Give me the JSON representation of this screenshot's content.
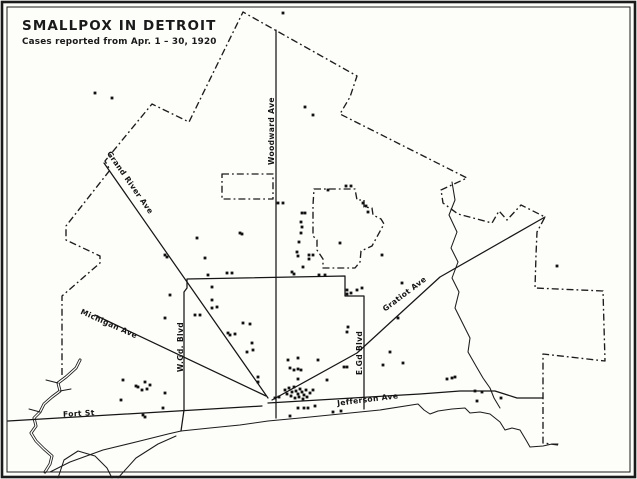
{
  "title": "SMALLPOX IN DETROIT",
  "subtitle": "Cases reported from Apr. 1 – 30, 1920",
  "colors": {
    "ink": "#1a1a1a",
    "paper": "#fdfdfa"
  },
  "map": {
    "width": 637,
    "height": 479,
    "city_boundary": [
      [
        [
          62,
          375
        ],
        [
          62,
          296
        ],
        [
          100,
          263
        ],
        [
          100,
          256
        ],
        [
          66,
          240
        ],
        [
          66,
          226
        ],
        [
          110,
          170
        ],
        [
          105,
          161
        ],
        [
          152,
          104
        ],
        [
          189,
          122
        ],
        [
          243,
          12
        ],
        [
          357,
          76
        ],
        [
          350,
          97
        ],
        [
          340,
          114
        ],
        [
          467,
          178
        ],
        [
          441,
          190
        ],
        [
          443,
          203
        ],
        [
          458,
          214
        ],
        [
          492,
          223
        ],
        [
          499,
          211
        ],
        [
          507,
          220
        ],
        [
          521,
          205
        ],
        [
          545,
          217
        ],
        [
          537,
          232
        ],
        [
          536,
          255
        ],
        [
          535,
          288
        ],
        [
          603,
          291
        ],
        [
          605,
          361
        ],
        [
          543,
          354
        ],
        [
          543,
          443
        ],
        [
          558,
          445
        ]
      ]
    ],
    "enclaves": [
      {
        "name": "enclave-northwest",
        "points": [
          [
            222,
            174
          ],
          [
            273,
            174
          ],
          [
            273,
            199
          ],
          [
            222,
            199
          ]
        ],
        "closed": true
      },
      {
        "name": "enclave-northeast",
        "points": [
          [
            314,
            189
          ],
          [
            355,
            189
          ],
          [
            357,
            200
          ],
          [
            364,
            200
          ],
          [
            364,
            207
          ],
          [
            372,
            208
          ],
          [
            373,
            215
          ],
          [
            381,
            219
          ],
          [
            384,
            224
          ],
          [
            372,
            246
          ],
          [
            361,
            251
          ],
          [
            360,
            262
          ],
          [
            355,
            268
          ],
          [
            323,
            268
          ],
          [
            323,
            259
          ],
          [
            317,
            250
          ],
          [
            317,
            240
          ],
          [
            313,
            236
          ],
          [
            313,
            205
          ],
          [
            314,
            189
          ]
        ],
        "closed": true
      }
    ],
    "streets": {
      "lines": [
        {
          "name": "woodward-ave",
          "points": [
            [
              276,
              30
            ],
            [
              276,
              418
            ]
          ]
        },
        {
          "name": "grand-river-ave",
          "points": [
            [
              104,
              163
            ],
            [
              268,
              398
            ]
          ]
        },
        {
          "name": "michigan-ave",
          "points": [
            [
              95,
              315
            ],
            [
              266,
              396
            ]
          ]
        },
        {
          "name": "gratiot-ave",
          "points": [
            [
              272,
              400
            ],
            [
              357,
              353
            ],
            [
              440,
              277
            ],
            [
              545,
              217
            ]
          ]
        },
        {
          "name": "jefferson-ave",
          "points": [
            [
              268,
              403
            ],
            [
              420,
              394
            ],
            [
              460,
              391
            ],
            [
              495,
              391
            ],
            [
              517,
              398
            ],
            [
              543,
              398
            ]
          ]
        },
        {
          "name": "fort-st",
          "points": [
            [
              8,
              421
            ],
            [
              262,
              406
            ]
          ]
        },
        {
          "name": "grand-blvd",
          "points": [
            [
              181,
              431
            ],
            [
              184,
              410
            ],
            [
              184,
              292
            ],
            [
              187,
              288
            ],
            [
              187,
              279
            ],
            [
              345,
              276
            ],
            [
              345,
              296
            ],
            [
              364,
              296
            ],
            [
              364,
              409
            ]
          ]
        }
      ],
      "labels": [
        {
          "name": "grand-river-ave-label",
          "text": "Grand River Ave",
          "x": 128,
          "y": 184,
          "rot": 55
        },
        {
          "name": "woodward-ave-label",
          "text": "Woodward Ave",
          "x": 274,
          "y": 131,
          "rot": -90
        },
        {
          "name": "w-grand-blvd-label",
          "text": "W.Gd. Blvd",
          "x": 183,
          "y": 347,
          "rot": -90
        },
        {
          "name": "e-grand-blvd-label",
          "text": "E.Gd Blvd",
          "x": 362,
          "y": 353,
          "rot": -90
        },
        {
          "name": "michigan-ave-label",
          "text": "Michigan Ave",
          "x": 108,
          "y": 326,
          "rot": 24
        },
        {
          "name": "gratiot-ave-label",
          "text": "Gratiot Ave",
          "x": 406,
          "y": 296,
          "rot": -37
        },
        {
          "name": "jefferson-ave-label",
          "text": "Jefferson Ave",
          "x": 368,
          "y": 402,
          "rot": -7
        },
        {
          "name": "fort-st-label",
          "text": "Fort St",
          "x": 79,
          "y": 416,
          "rot": -3
        }
      ]
    },
    "water": {
      "shoreline": [
        [
          [
            50,
            472
          ],
          [
            70,
            462
          ],
          [
            103,
            450
          ],
          [
            140,
            441
          ],
          [
            168,
            434
          ],
          [
            181,
            431
          ],
          [
            210,
            428
          ],
          [
            240,
            425
          ],
          [
            268,
            421
          ],
          [
            300,
            418
          ],
          [
            340,
            414
          ],
          [
            380,
            410
          ],
          [
            418,
            404
          ],
          [
            424,
            410
          ],
          [
            430,
            414
          ],
          [
            438,
            411
          ],
          [
            452,
            409
          ],
          [
            465,
            408
          ],
          [
            470,
            413
          ],
          [
            480,
            412
          ],
          [
            490,
            414
          ],
          [
            500,
            422
          ],
          [
            505,
            430
          ],
          [
            512,
            428
          ],
          [
            520,
            430
          ],
          [
            526,
            440
          ],
          [
            530,
            447
          ],
          [
            543,
            446
          ],
          [
            552,
            444
          ],
          [
            558,
            444
          ]
        ],
        [
          [
            118,
            478
          ],
          [
            136,
            458
          ],
          [
            158,
            444
          ],
          [
            176,
            436
          ]
        ]
      ],
      "creek": [
        [
          [
            452,
            182
          ],
          [
            455,
            200
          ],
          [
            449,
            215
          ],
          [
            457,
            232
          ],
          [
            451,
            248
          ],
          [
            458,
            262
          ],
          [
            452,
            278
          ],
          [
            459,
            292
          ],
          [
            455,
            308
          ],
          [
            462,
            322
          ],
          [
            470,
            338
          ],
          [
            468,
            352
          ],
          [
            476,
            366
          ],
          [
            483,
            378
          ],
          [
            490,
            388
          ],
          [
            494,
            398
          ],
          [
            500,
            408
          ]
        ]
      ],
      "river_rouge": {
        "main": [
          [
            80,
            360
          ],
          [
            76,
            368
          ],
          [
            66,
            377
          ],
          [
            58,
            383
          ],
          [
            60,
            391
          ],
          [
            52,
            397
          ],
          [
            44,
            404
          ],
          [
            40,
            412
          ],
          [
            34,
            418
          ],
          [
            36,
            426
          ],
          [
            31,
            433
          ],
          [
            36,
            441
          ],
          [
            44,
            449
          ],
          [
            52,
            456
          ],
          [
            50,
            464
          ],
          [
            45,
            472
          ]
        ],
        "spurs": [
          [
            [
              58,
              383
            ],
            [
              46,
              380
            ]
          ],
          [
            [
              60,
              391
            ],
            [
              71,
              389
            ]
          ],
          [
            [
              40,
              412
            ],
            [
              29,
              409
            ]
          ]
        ]
      },
      "island": [
        [
          58,
          478
        ],
        [
          64,
          460
        ],
        [
          78,
          451
        ],
        [
          95,
          456
        ],
        [
          107,
          468
        ],
        [
          112,
          478
        ]
      ]
    },
    "cases": [
      [
        283,
        13
      ],
      [
        95,
        93
      ],
      [
        112,
        98
      ],
      [
        305,
        107
      ],
      [
        313,
        115
      ],
      [
        346,
        186
      ],
      [
        351,
        186
      ],
      [
        328,
        190
      ],
      [
        278,
        203
      ],
      [
        283,
        203
      ],
      [
        363,
        203
      ],
      [
        366,
        206
      ],
      [
        368,
        212
      ],
      [
        302,
        213
      ],
      [
        305,
        213
      ],
      [
        301,
        222
      ],
      [
        302,
        227
      ],
      [
        240,
        233
      ],
      [
        301,
        233
      ],
      [
        242,
        234
      ],
      [
        197,
        238
      ],
      [
        299,
        242
      ],
      [
        340,
        243
      ],
      [
        297,
        252
      ],
      [
        309,
        255
      ],
      [
        313,
        255
      ],
      [
        382,
        255
      ],
      [
        165,
        255
      ],
      [
        298,
        256
      ],
      [
        167,
        257
      ],
      [
        205,
        258
      ],
      [
        309,
        259
      ],
      [
        557,
        266
      ],
      [
        303,
        267
      ],
      [
        292,
        272
      ],
      [
        294,
        274
      ],
      [
        227,
        273
      ],
      [
        232,
        273
      ],
      [
        208,
        275
      ],
      [
        319,
        275
      ],
      [
        325,
        275
      ],
      [
        402,
        283
      ],
      [
        362,
        288
      ],
      [
        347,
        290
      ],
      [
        357,
        290
      ],
      [
        351,
        293
      ],
      [
        347,
        294
      ],
      [
        212,
        287
      ],
      [
        170,
        295
      ],
      [
        212,
        300
      ],
      [
        217,
        307
      ],
      [
        212,
        308
      ],
      [
        195,
        315
      ],
      [
        200,
        315
      ],
      [
        398,
        318
      ],
      [
        165,
        318
      ],
      [
        243,
        323
      ],
      [
        250,
        324
      ],
      [
        348,
        327
      ],
      [
        347,
        332
      ],
      [
        228,
        333
      ],
      [
        235,
        334
      ],
      [
        230,
        335
      ],
      [
        252,
        343
      ],
      [
        253,
        350
      ],
      [
        247,
        352
      ],
      [
        390,
        352
      ],
      [
        403,
        363
      ],
      [
        383,
        365
      ],
      [
        347,
        367
      ],
      [
        123,
        380
      ],
      [
        145,
        382
      ],
      [
        150,
        385
      ],
      [
        136,
        386
      ],
      [
        138,
        387
      ],
      [
        147,
        389
      ],
      [
        142,
        390
      ],
      [
        165,
        393
      ],
      [
        121,
        400
      ],
      [
        163,
        408
      ],
      [
        143,
        415
      ],
      [
        145,
        417
      ],
      [
        298,
        358
      ],
      [
        288,
        360
      ],
      [
        318,
        360
      ],
      [
        344,
        367
      ],
      [
        290,
        368
      ],
      [
        298,
        369
      ],
      [
        294,
        370
      ],
      [
        301,
        370
      ],
      [
        258,
        377
      ],
      [
        298,
        379
      ],
      [
        327,
        380
      ],
      [
        258,
        382
      ],
      [
        294,
        387
      ],
      [
        289,
        388
      ],
      [
        300,
        389
      ],
      [
        285,
        390
      ],
      [
        306,
        390
      ],
      [
        313,
        390
      ],
      [
        296,
        391
      ],
      [
        292,
        392
      ],
      [
        302,
        392
      ],
      [
        310,
        393
      ],
      [
        287,
        394
      ],
      [
        298,
        394
      ],
      [
        304,
        395
      ],
      [
        291,
        396
      ],
      [
        299,
        397
      ],
      [
        307,
        397
      ],
      [
        295,
        398
      ],
      [
        303,
        399
      ],
      [
        279,
        397
      ],
      [
        275,
        398
      ],
      [
        315,
        406
      ],
      [
        298,
        408
      ],
      [
        304,
        408
      ],
      [
        308,
        408
      ],
      [
        333,
        412
      ],
      [
        341,
        411
      ],
      [
        290,
        416
      ],
      [
        455,
        377
      ],
      [
        452,
        378
      ],
      [
        447,
        379
      ],
      [
        475,
        391
      ],
      [
        482,
        392
      ],
      [
        501,
        398
      ],
      [
        477,
        401
      ]
    ]
  }
}
